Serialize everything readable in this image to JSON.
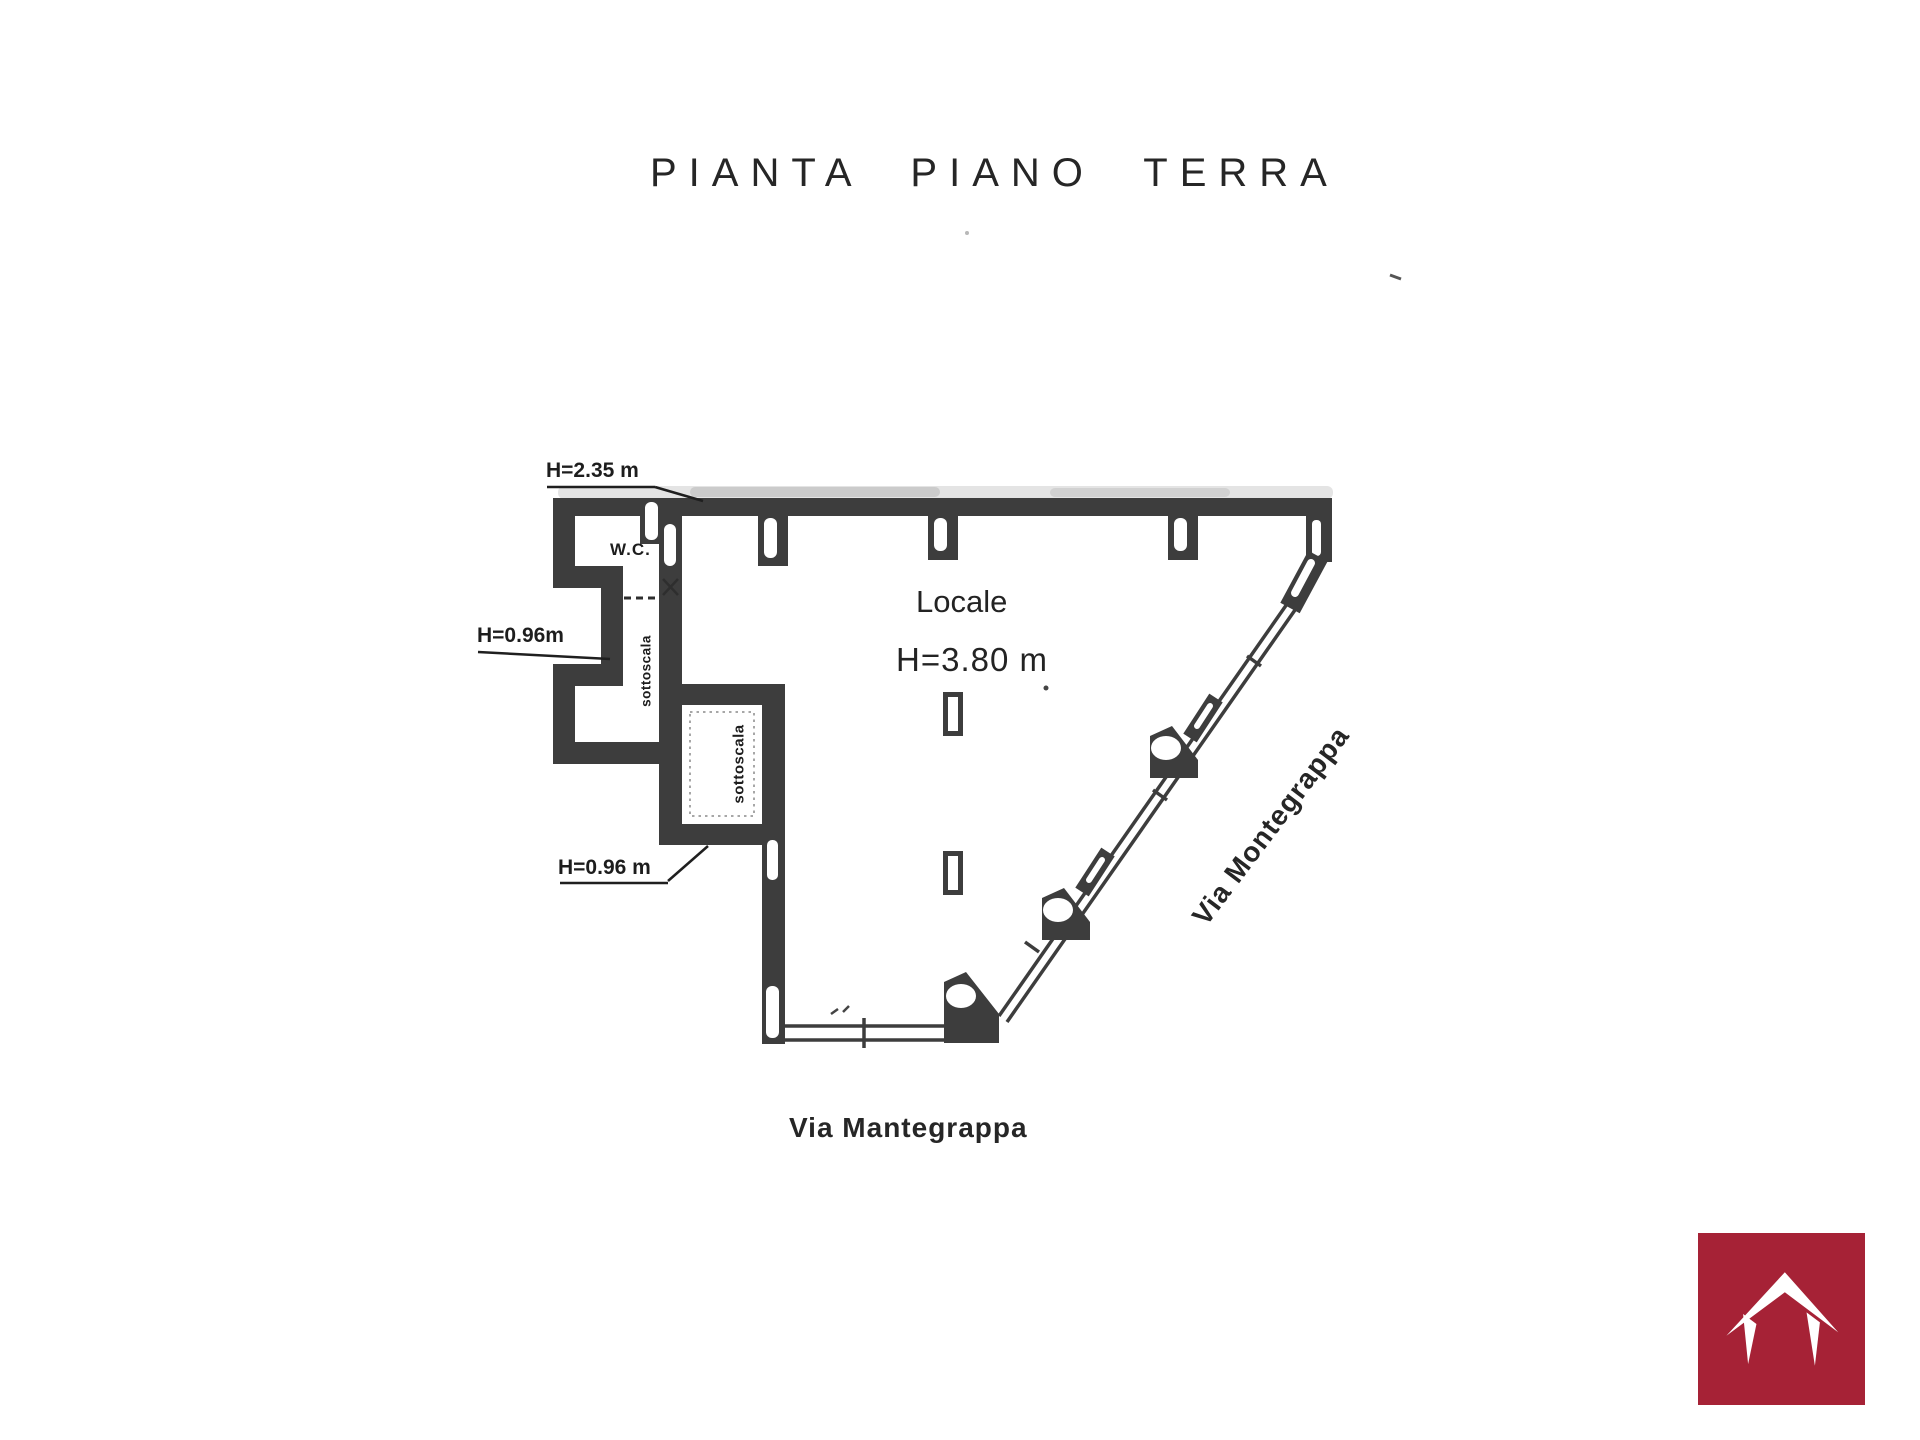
{
  "title": "PIANTA PIANO TERRA",
  "plan_labels": {
    "h_235": "H=2.35 m",
    "wc": "W.C.",
    "h_096_upper": "H=0.96m",
    "sottoscala_upper": "sottoscala",
    "sottoscala_lower": "sottoscala",
    "room_name": "Locale",
    "room_height": "H=3.80 m",
    "h_096_lower": "H=0.96 m"
  },
  "street_labels": {
    "right_diagonal": "Via Montegrappa",
    "bottom": "Via Mantegrappa"
  },
  "colors": {
    "ink": "#3d3d3d",
    "text": "#1d1d1d",
    "logo_background": "#a62236",
    "logo_glyph": "#ffffff",
    "page_background": "#ffffff"
  },
  "logo": {
    "icon": "roof-icon"
  }
}
